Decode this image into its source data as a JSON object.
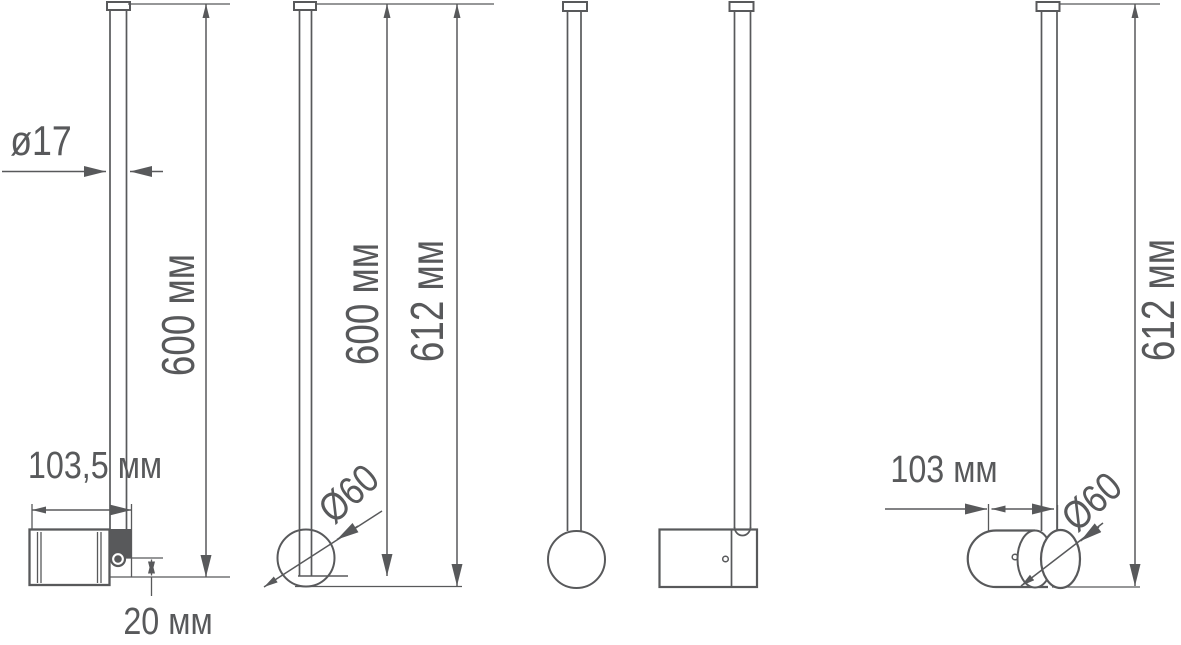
{
  "drawing": {
    "description": "Technical dimension drawing of a pendant rod luminaire, five orthographic/perspective views",
    "units": "мм",
    "colors": {
      "line": "#58595b",
      "background": "#ffffff"
    },
    "views": [
      {
        "name": "side-view-with-bracket",
        "labels_shown": [
          "ø17",
          "600 мм",
          "103,5 мм",
          "20 мм"
        ]
      },
      {
        "name": "side-view-rod-and-end-circle",
        "labels_shown": [
          "600 мм",
          "612 мм",
          "Ø60"
        ]
      },
      {
        "name": "front-view-rod-and-circle",
        "labels_shown": []
      },
      {
        "name": "front-view-rod-and-cylinder-body",
        "labels_shown": []
      },
      {
        "name": "angled-view-cylinder-body",
        "labels_shown": [
          "103 мм",
          "Ø60",
          "612 мм"
        ]
      }
    ]
  },
  "labels": {
    "rod_diameter": "ø17",
    "v1_length": "600 мм",
    "v1_body_depth": "103,5 мм",
    "v1_offset": "20 мм",
    "v2_length": "600 мм",
    "v2_total_length": "612 мм",
    "v2_body_diameter": "Ø60",
    "v5_body_depth": "103 мм",
    "v5_body_diameter": "Ø60",
    "v5_total_length": "612 мм"
  }
}
